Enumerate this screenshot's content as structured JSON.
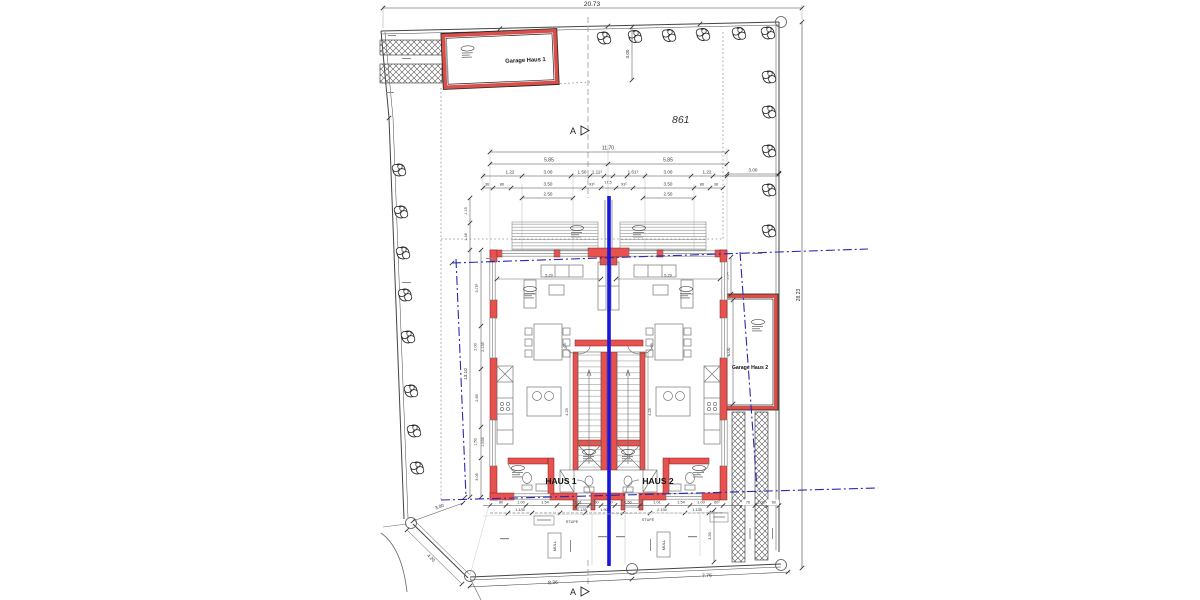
{
  "parcel_number": "861",
  "section_letter": "A",
  "site_dims": {
    "top_width": "20.73",
    "right_depth": "28.23",
    "bottom_left": "8.36",
    "bottom_right": "7.76",
    "corner_diag": "4.20",
    "corner_short": "3.00",
    "north_offset": "3.00",
    "east_offset": "3.00"
  },
  "garage1_label": "Garage Haus 1",
  "garage2_label": "Garage Haus 2",
  "garage2_depth": "6.00",
  "haus1_label": "HAUS 1",
  "haus2_label": "HAUS 2",
  "top_chain": {
    "total": "11.70",
    "half_left": "5.85",
    "half_right": "5.85",
    "row3": [
      "1.22",
      "3.00",
      "1.50",
      "1.11⁵",
      "1.61⁵",
      "3.00",
      "1.22"
    ],
    "row4": [
      "36",
      "86",
      "3.50",
      "93⁵",
      "17,5",
      "93⁵",
      "3.50",
      "86",
      "36"
    ],
    "window_left": "2.50",
    "window_right": "2.50"
  },
  "left_chain": {
    "seg1": "1.15",
    "seg2": "1.48",
    "total": "13.10",
    "rooms": [
      "3.75⁵",
      "2.00",
      "2.135",
      "2.85",
      "1.50",
      "1.535",
      "3.05"
    ]
  },
  "right_chain": {
    "wall": "36",
    "offset": "2.04⁵",
    "south": "3.50"
  },
  "interior_dims": {
    "living": "5.29",
    "stair": "4.25",
    "bay": "1.05"
  },
  "bottom_chain": {
    "row1": [
      "80",
      "1.00",
      "1.54",
      "1.01",
      ".60",
      ".60",
      "1.50",
      "1.01",
      "1.54",
      "1.00",
      "60⁵",
      "70",
      "1.00",
      "60"
    ],
    "row2": [
      "1.135",
      "2.135",
      "1.90",
      "2.135",
      "1.135"
    ]
  },
  "yard_labels": {
    "stufe": "STUFE",
    "muell": "MÜLL"
  }
}
